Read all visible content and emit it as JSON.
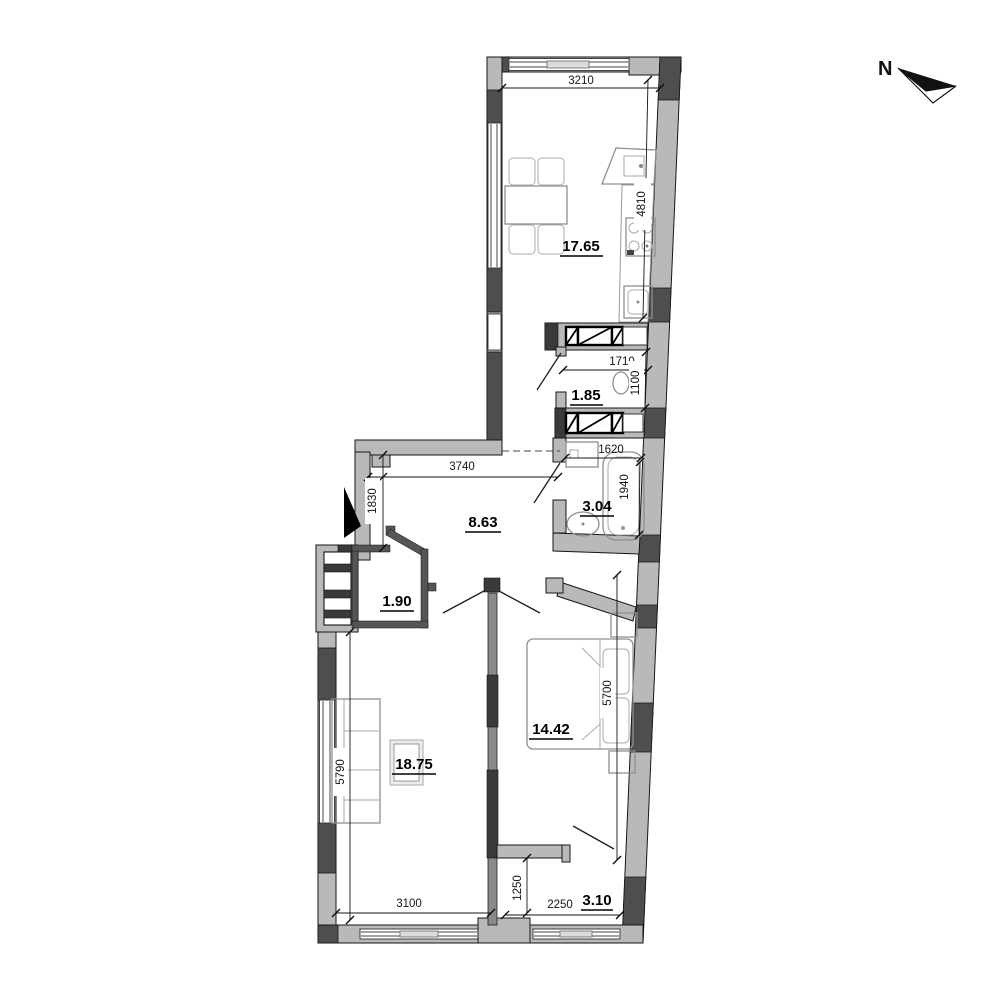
{
  "compass": {
    "label": "N"
  },
  "areas": {
    "kitchen_living": "17.65",
    "wc": "1.85",
    "bathroom": "3.04",
    "hall": "8.63",
    "wardrobe": "1.90",
    "living_room": "18.75",
    "bedroom": "14.42",
    "balcony": "3.10"
  },
  "dims": {
    "kitchen_width": "3210",
    "kitchen_depth": "4810",
    "wc_width": "1710",
    "wc_depth": "1100",
    "bath_width": "1620",
    "bath_depth": "1940",
    "hall_width": "3740",
    "hall_depth": "1830",
    "living_depth": "5790",
    "living_width": "3100",
    "bedroom_depth": "5700",
    "balcony_width": "2250",
    "balcony_depth": "1250"
  },
  "colors": {
    "wall": "#b9b9b9",
    "pier": "#4e4e4e",
    "line": "#161616",
    "furniture": "#8f8f8f",
    "dim_text": "#151515"
  }
}
